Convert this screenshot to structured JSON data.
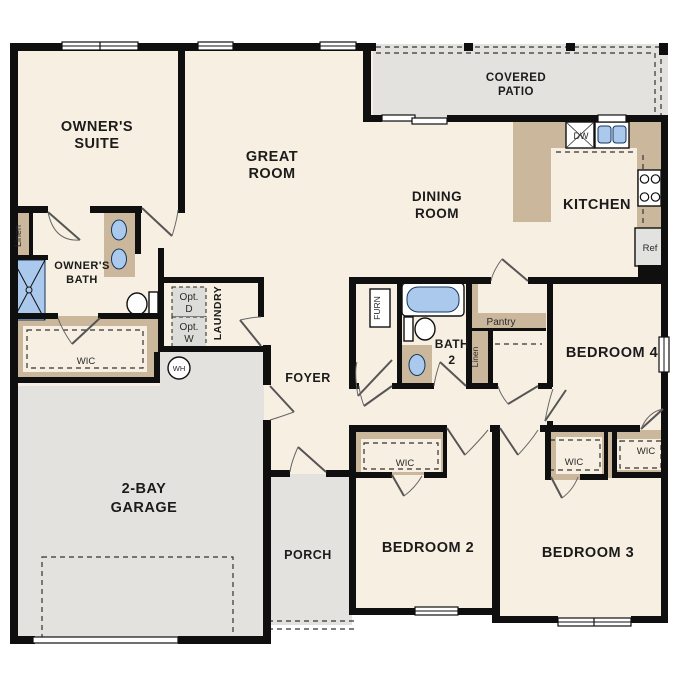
{
  "colors": {
    "floor": "#f7efe1",
    "exterior_surface": "#e3e2de",
    "casework": "#cbb89c",
    "fixture_blue": "#aac9ec",
    "wall": "#0f0f0f",
    "optional_appliance_fill": "#dcdcd8"
  },
  "rooms": {
    "owners_suite": {
      "l1": "OWNER'S",
      "l2": "SUITE"
    },
    "great_room": {
      "l1": "GREAT",
      "l2": "ROOM"
    },
    "covered_patio": {
      "l1": "COVERED",
      "l2": "PATIO"
    },
    "dining_room": {
      "l1": "DINING",
      "l2": "ROOM"
    },
    "kitchen": {
      "label": "KITCHEN"
    },
    "owners_bath": {
      "l1": "OWNER'S",
      "l2": "BATH"
    },
    "laundry": {
      "label": "LAUNDRY"
    },
    "foyer": {
      "label": "FOYER"
    },
    "garage": {
      "l1": "2-BAY",
      "l2": "GARAGE"
    },
    "porch": {
      "label": "PORCH"
    },
    "bath_2": {
      "l1": "BATH",
      "l2": "2"
    },
    "bedroom_2": {
      "label": "BEDROOM 2"
    },
    "bedroom_3": {
      "label": "BEDROOM 3"
    },
    "bedroom_4": {
      "label": "BEDROOM 4"
    }
  },
  "closets": {
    "linen_owners": "Linen",
    "linen_hall": "Linen",
    "wic_owners": "WIC",
    "wic_bedroom_2": "WIC",
    "wic_bedroom_3": "WIC",
    "wic_bedroom_4": "WIC",
    "pantry": "Pantry"
  },
  "fixtures": {
    "water_heater": "WH",
    "dishwasher": "DW",
    "refrigerator": "Ref",
    "furnace": "FURN",
    "opt_dryer": {
      "l1": "Opt.",
      "l2": "D"
    },
    "opt_washer": {
      "l1": "Opt.",
      "l2": "W"
    }
  }
}
